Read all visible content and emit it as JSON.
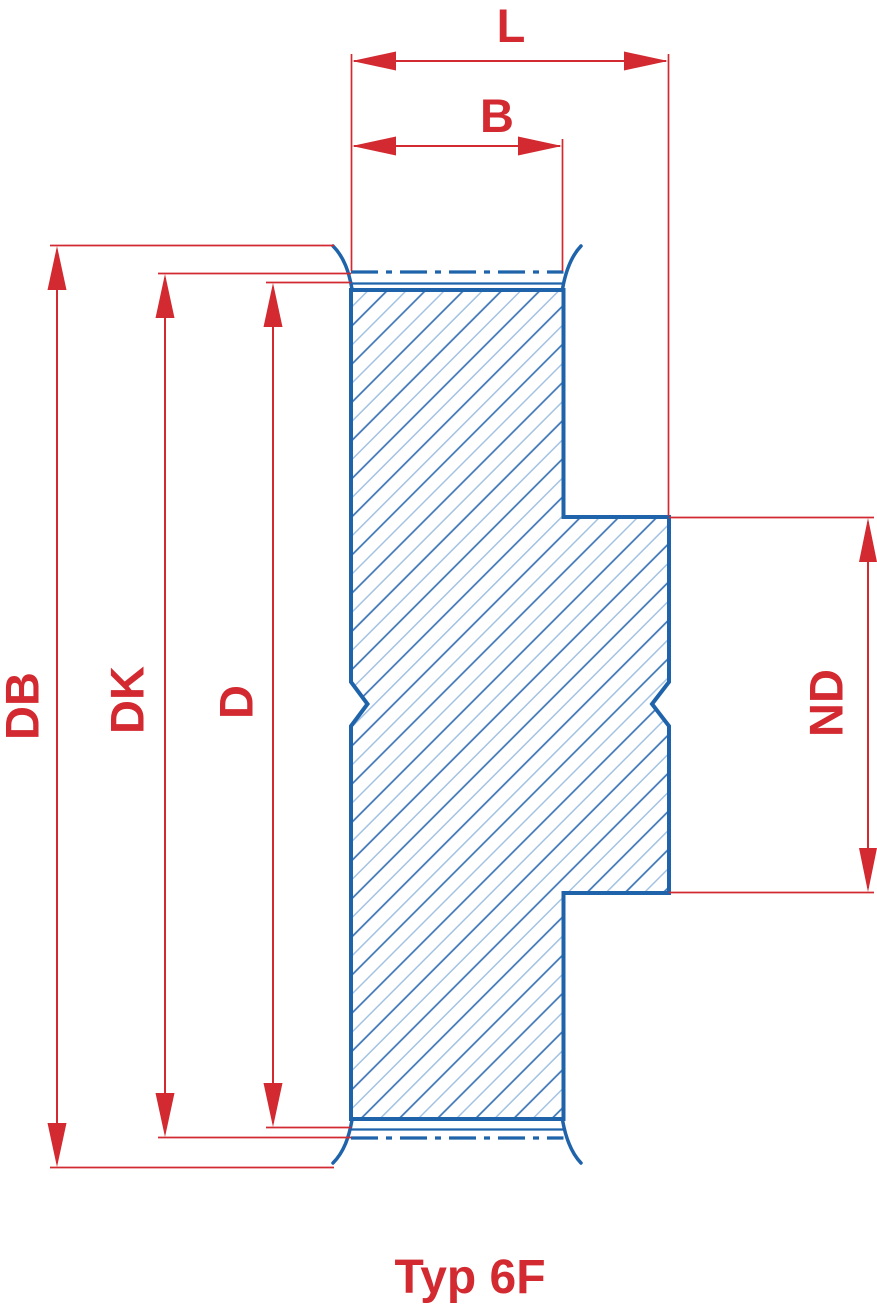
{
  "drawing": {
    "caption": "Typ 6F",
    "labels": {
      "L": "L",
      "B": "B",
      "DB": "DB",
      "DK": "DK",
      "D": "D",
      "ND": "ND"
    },
    "colors": {
      "dimension_red": "#d22a30",
      "outline_blue": "#1f63ab",
      "hatch_dark": "#3f76b5",
      "hatch_light": "#a4c2e2",
      "background": "#ffffff"
    }
  }
}
